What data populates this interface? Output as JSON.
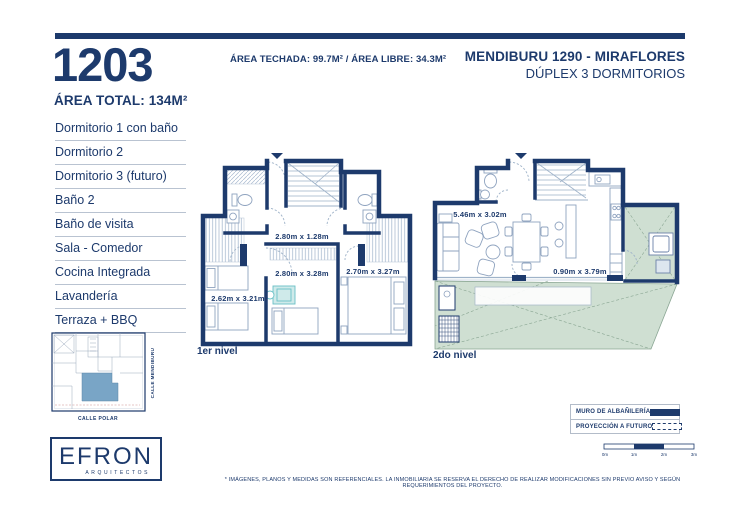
{
  "unit": {
    "number": "1203",
    "area_total": "ÁREA TOTAL: 134M²"
  },
  "header": {
    "areas_line": "ÁREA TECHADA: 99.7M² / ÁREA LIBRE: 34.3M²",
    "project_title": "MENDIBURU 1290 - MIRAFLORES",
    "project_subtitle": "DÚPLEX 3 DORMITORIOS"
  },
  "rooms": [
    "Dormitorio 1 con baño",
    "Dormitorio 2",
    "Dormitorio 3 (futuro)",
    "Baño 2",
    "Baño de visita",
    "Sala - Comedor",
    "Cocina Integrada",
    "Lavandería",
    "Terraza + BBQ"
  ],
  "plans": {
    "level1": {
      "label": "1er nivel",
      "dim_hall": "2.80m x 1.28m",
      "dim_left": "2.62m x 3.21m",
      "dim_middle": "2.80m x 3.28m",
      "dim_right": "2.70m x 3.27m"
    },
    "level2": {
      "label": "2do nivel",
      "dim_sala": "5.46m x 3.02m",
      "dim_lavanderia": "0.90m x 3.79m"
    }
  },
  "site_map": {
    "street_right": "CALLE MENDIBURU",
    "street_bottom": "CALLE POLAR"
  },
  "logo": {
    "brand": "EFRON",
    "tagline": "ARQUITECTOS"
  },
  "legend": {
    "muro": "MURO DE ALBAÑILERÍA",
    "proyeccion": "PROYECCIÓN A FUTURO"
  },
  "scale_bar": {
    "ticks": [
      "0m",
      "1m",
      "2m",
      "3m"
    ]
  },
  "disclaimer": "* IMÁGENES, PLANOS Y MEDIDAS SON REFERENCIALES. LA INMOBILIARIA SE RESERVA EL DERECHO DE REALIZAR MODIFICACIONES SIN PREVIO AVISO Y SEGÚN REQUERIMIENTOS DEL PROYECTO.",
  "colors": {
    "navy": "#1d3a6c",
    "terrace_green": "#cfdfd2",
    "unit_highlight": "#79a5c6",
    "accent_teal": "#69c0c6"
  }
}
